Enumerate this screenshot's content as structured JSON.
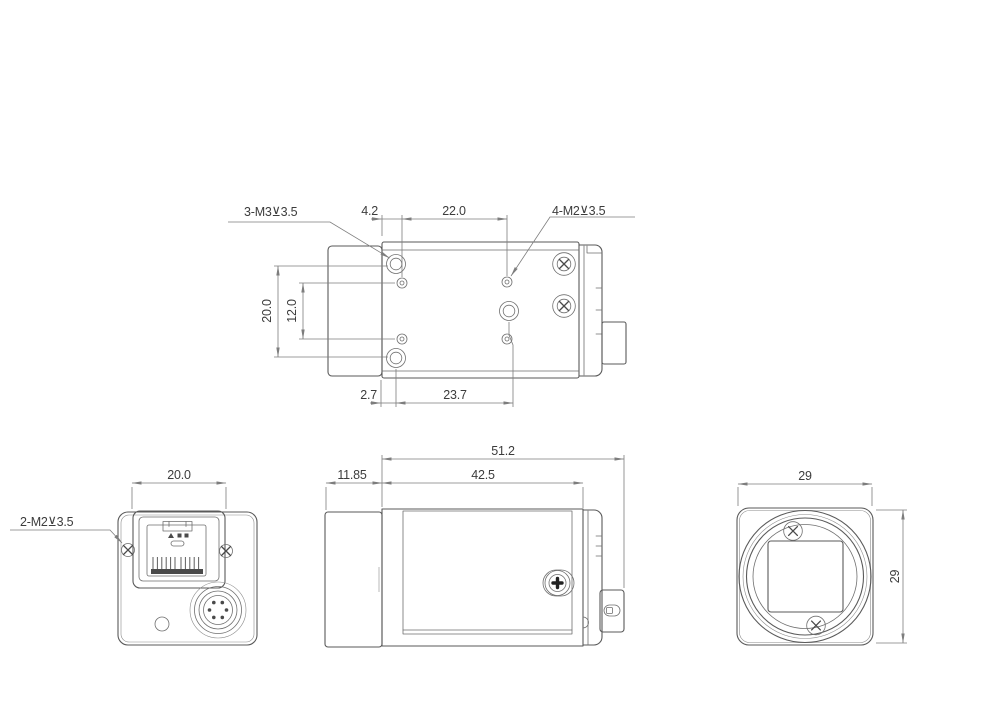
{
  "meta": {
    "type": "engineering-dimensional-drawing",
    "subject": "industrial camera (GigE machine-vision camera), four orthographic views",
    "units": "mm"
  },
  "colors": {
    "background": "#ffffff",
    "outline": "#5a5a5a",
    "detail": "#6f6f6f",
    "dimension": "#7d7d7d",
    "text": "#3c3c3c",
    "dark_fill": "#4a4a4a"
  },
  "top_view": {
    "thread_label_m3": "3-M3⊻3.5",
    "thread_label_m2": "4-M2⊻3.5",
    "dim_edge_to_hole": "4.2",
    "dim_hole_span": "22.0",
    "dim_outer_holes": "20.0",
    "dim_inner_holes": "12.0",
    "dim_edge_offset": "2.7",
    "dim_bottom_span": "23.7"
  },
  "rear_view": {
    "thread_label_m2": "2-M2⊻3.5",
    "dim_connector_width": "20.0"
  },
  "side_view": {
    "dim_overall_length": "51.2",
    "dim_lens_mount": "11.85",
    "dim_body_length": "42.5"
  },
  "front_view": {
    "dim_width": "29",
    "dim_height": "29"
  }
}
